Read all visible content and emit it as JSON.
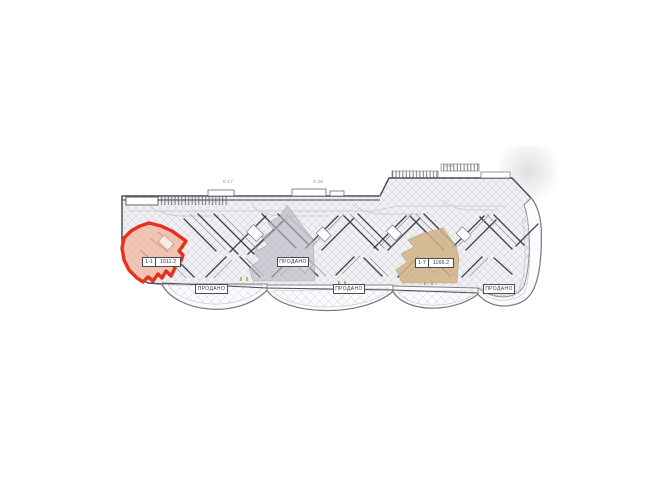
{
  "canvas": {
    "width": 653,
    "height": 489,
    "background": "#ffffff"
  },
  "selected_unit": {
    "number": "1-1",
    "area": "1011.2"
  },
  "tan_unit": {
    "number": "1-7",
    "area": "1165.2"
  },
  "sold_labels": [
    "ПРОДАНО",
    "ПРОДАНО",
    "ПРОДАНО",
    "ПРОДАНО"
  ],
  "dimensions": [
    "8.17",
    "8.38",
    "8.38"
  ],
  "colors": {
    "selected_outline": "#e8311d",
    "selected_fill": "#f2b9a6",
    "sold_unit_fill": "#b9b9c4",
    "tan_unit_fill": "#d2b287",
    "plan_base_fill": "#f0f0f3",
    "wall_dark": "#3f3f49",
    "wall_mid": "#8f8f99",
    "hatch_light": "#b6b6c0"
  }
}
